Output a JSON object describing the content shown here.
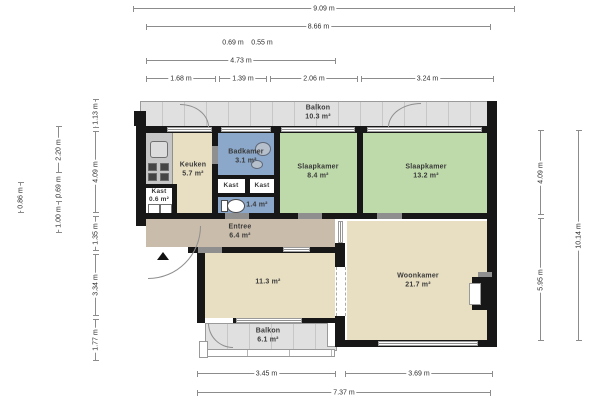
{
  "plan": {
    "colors": {
      "wall": "#171717",
      "bedroom_green": "#bedaaa",
      "bathroom_blue": "#8ba7c9",
      "living_beige": "#e8dfc2",
      "hallway_tan": "#c9bcab",
      "balcony_grey": "#e0e0e0",
      "closet_white": "#ffffff"
    },
    "rooms": {
      "balkon_top": {
        "name": "Balkon",
        "area": "10.3 m²"
      },
      "keuken": {
        "name": "Keuken",
        "area": "5.7 m²"
      },
      "badkamer": {
        "name": "Badkamer",
        "area": "3.1 m²"
      },
      "kast_left": {
        "name": "Kast"
      },
      "kast_right": {
        "name": "Kast"
      },
      "kast_small": {
        "name": "Kast",
        "area": "0.6 m²"
      },
      "toilet": {
        "area": "1.4 m²"
      },
      "slaapkamer_1": {
        "name": "Slaapkamer",
        "area": "8.4 m²"
      },
      "slaapkamer_2": {
        "name": "Slaapkamer",
        "area": "13.2 m²"
      },
      "entree": {
        "name": "Entree",
        "area": "6.4 m²"
      },
      "kamer": {
        "area": "11.3 m²"
      },
      "woonkamer": {
        "name": "Woonkamer",
        "area": "21.7 m²"
      },
      "balkon_bottom": {
        "name": "Balkon",
        "area": "6.1 m²"
      }
    },
    "dimensions": {
      "top": [
        {
          "label": "9.09 m"
        },
        {
          "label": "8.66 m"
        },
        {
          "label": "0.69 m"
        },
        {
          "label": "0.55 m"
        },
        {
          "label": "4.73 m"
        },
        {
          "label": "1.68 m"
        },
        {
          "label": "1.39 m"
        },
        {
          "label": "2.06 m"
        },
        {
          "label": "3.24 m"
        }
      ],
      "left": [
        {
          "label": "1.13 m"
        },
        {
          "label": "4.09 m"
        },
        {
          "label": "1.35 m"
        },
        {
          "label": "3.34 m"
        },
        {
          "label": "1.77 m"
        },
        {
          "label": "2.20 m"
        },
        {
          "label": "0.69 m"
        },
        {
          "label": "1.00 m"
        },
        {
          "label": "0.86 m"
        }
      ],
      "right": [
        {
          "label": "4.09 m"
        },
        {
          "label": "5.95 m"
        },
        {
          "label": "10.14 m"
        }
      ],
      "bottom": [
        {
          "label": "3.45 m"
        },
        {
          "label": "3.69 m"
        },
        {
          "label": "7.37 m"
        }
      ]
    }
  }
}
